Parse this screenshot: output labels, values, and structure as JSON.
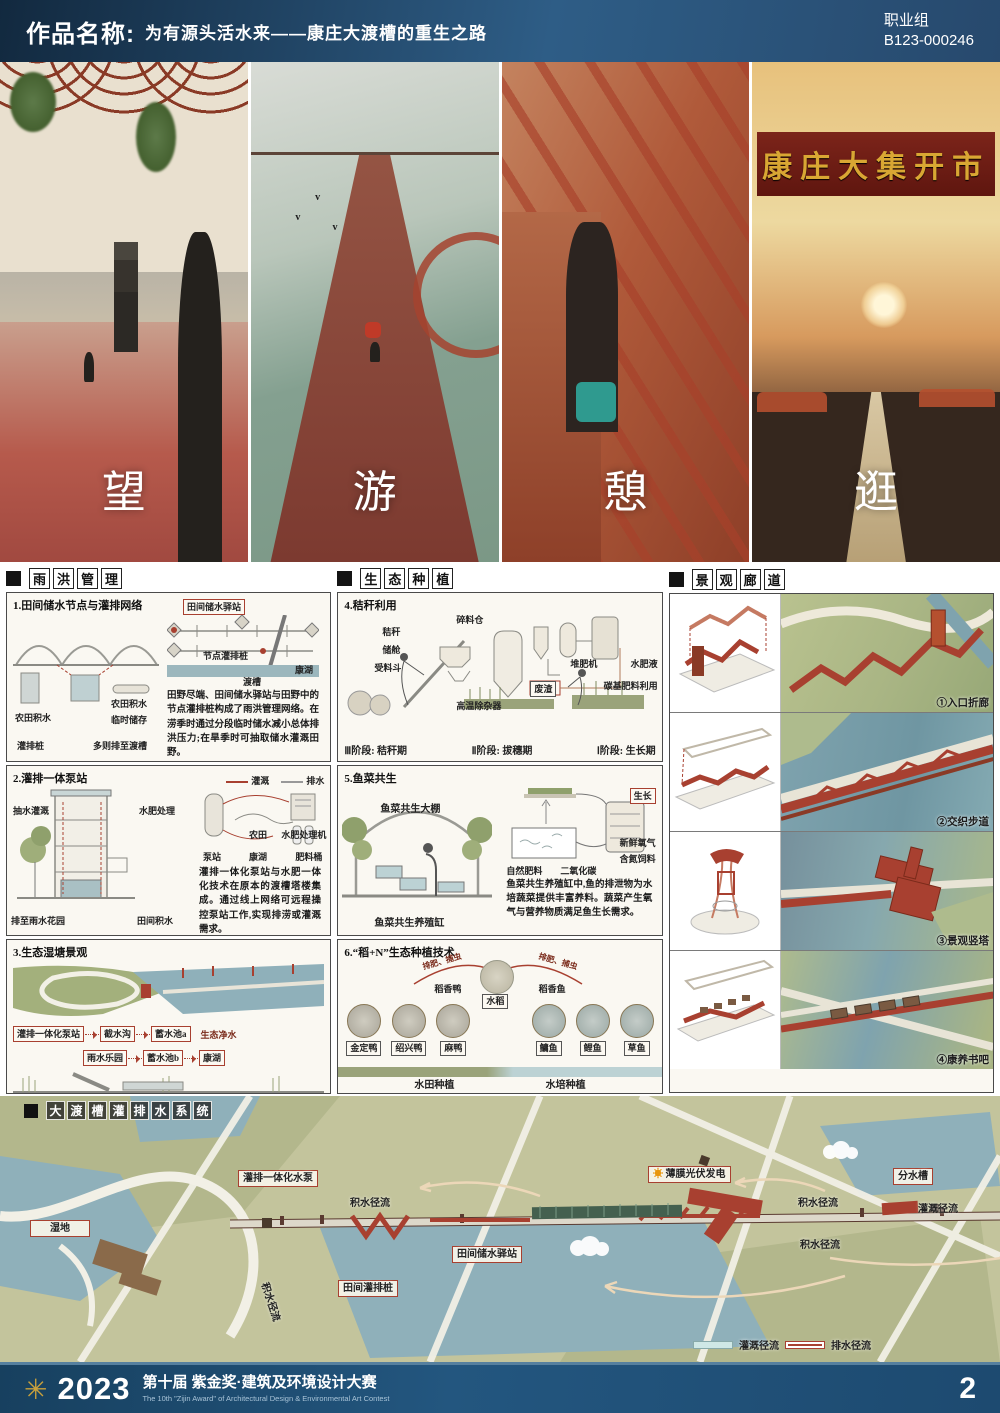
{
  "colors": {
    "accent_red": "#a84030",
    "header_blue": "#2e5d86",
    "water": "#8fb0ba",
    "field_green": "#c3c49c"
  },
  "header": {
    "label": "作品名称:",
    "title": "为有源头活水来——康庄大渡槽的重生之路",
    "group": "职业组",
    "code": "B123-000246"
  },
  "hero": {
    "chars": [
      "望",
      "游",
      "憩",
      "逛"
    ],
    "banner": "康庄大集开市"
  },
  "s1": {
    "title_chars": [
      "雨",
      "洪",
      "管",
      "理"
    ],
    "p1": {
      "title": "1.田间储水节点与灌排网络",
      "labels": {
        "station": "田间储水驿站",
        "node_pile": "节点灌排桩",
        "aqueduct": "渡槽",
        "lake": "康湖",
        "field_water_l": "农田积水",
        "field_water_r": "农田积水",
        "temp": "临时储存",
        "pile": "灌排桩",
        "overflow": "多则排至渡槽"
      },
      "text": "田野尽端、田间储水驿站与田野中的节点灌排桩构成了雨洪管理网络。在涝季时通过分段临时储水减小总体排洪压力;在旱季时可抽取储水灌溉田野。"
    },
    "p2": {
      "title": "2.灌排一体泵站",
      "legend": [
        "灌溉",
        "排水"
      ],
      "labels": {
        "pump_irr": "抽水灌溉",
        "fert": "水肥处理",
        "to_garden": "排至雨水花园",
        "field_water": "田间积水",
        "pump": "泵站",
        "farm": "农田",
        "lake": "康湖",
        "machine": "水肥处理机",
        "barrel": "肥料桶"
      },
      "text": "灌排一体化泵站与水肥一体化技术在原本的渡槽塔楼集成。通过线上网络可远程操控泵站工作,实现排涝或灌溉需求。"
    },
    "p3": {
      "title": "3.生态湿塘景观",
      "purify": "生态净水",
      "flow": [
        "灌排一体化泵站",
        "截水沟",
        "蓄水池a",
        "雨水乐园",
        "蓄水池b",
        "康湖"
      ]
    }
  },
  "s2": {
    "title_chars": [
      "生",
      "态",
      "种",
      "植"
    ],
    "p4": {
      "title": "4.秸秆利用",
      "labels": {
        "straw": "秸秆",
        "cabin": "储舱",
        "hopper": "受料斗",
        "silo": "碎料仓",
        "remover": "高温除杂器",
        "waste": "废渣",
        "compost": "堆肥机",
        "liquid": "水肥液",
        "carbon": "碳基肥料利用"
      },
      "stages": [
        "Ⅲ阶段: 秸秆期",
        "Ⅱ阶段: 拔穗期",
        "Ⅰ阶段: 生长期"
      ]
    },
    "p5": {
      "title": "5.鱼菜共生",
      "labels": {
        "greenhouse": "鱼菜共生大棚",
        "tank": "鱼菜共生养殖缸",
        "grow": "生长",
        "natural": "自然肥料",
        "co2": "二氧化碳",
        "oxygen": "新鲜氧气",
        "feed": "含氮饲料"
      },
      "text": "鱼菜共生养殖缸中,鱼的排泄物为水培蔬菜提供丰富养料。蔬菜产生氧气与营养物质满足鱼生长需求。"
    },
    "p6": {
      "title": "6.“稻+N”生态种植技术",
      "labels": {
        "arc_left": "排肥、捕虫",
        "arc_right": "排肥、捕虫",
        "duck_group": "稻香鸭",
        "rice": "水稻",
        "fish_group": "稻香鱼",
        "paddy": "水田种植",
        "hydro": "水培种植"
      },
      "ducks": [
        "金定鸭",
        "绍兴鸭",
        "麻鸭"
      ],
      "fishes": [
        "鳙鱼",
        "鲤鱼",
        "草鱼"
      ]
    }
  },
  "s3": {
    "title_chars": [
      "景",
      "观",
      "廊",
      "道"
    ],
    "captions": [
      "①入口折廊",
      "②交织步道",
      "③景观竖塔",
      "④康养书吧"
    ]
  },
  "map": {
    "title_chars": [
      "大",
      "渡",
      "槽",
      "灌",
      "排",
      "水",
      "系",
      "统"
    ],
    "labels": {
      "wetland": "湿地",
      "pump": "灌排一体化水泵",
      "pv": "薄膜光伏发电",
      "divider": "分水槽",
      "station": "田间储水驿站",
      "pile": "田间灌排桩",
      "runoff_a": "积水径流",
      "runoff_b": "积水径流",
      "runoff_c": "积水径流",
      "runoff_d": "积水径流",
      "irr": "灌溉径流"
    },
    "legend": {
      "irr": "灌溉径流",
      "drain": "排水径流"
    }
  },
  "footer": {
    "year": "2023",
    "title": "第十届 紫金奖·建筑及环境设计大赛",
    "subtitle": "The 10th \"Zijin Award\" of Architectural Design & Environmental Art Contest",
    "page": "2"
  }
}
